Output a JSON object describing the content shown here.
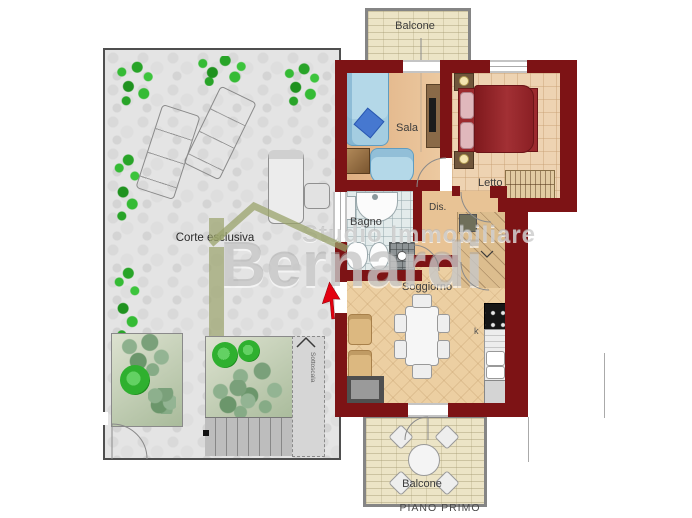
{
  "caption": {
    "floor": "PIANO PRIMO"
  },
  "rooms": {
    "balcone_top": {
      "label": "Balcone"
    },
    "sala": {
      "label": "Sala"
    },
    "letto": {
      "label": "Letto"
    },
    "bagno": {
      "label": "Bagno"
    },
    "dis": {
      "label": "Dis."
    },
    "soggiorno": {
      "label": "Soggiorno"
    },
    "kitchen": {
      "label": "k"
    },
    "corte": {
      "label": "Corte esclusiva"
    },
    "balcone_bottom": {
      "label": "Balcone"
    },
    "sottoscala": {
      "label": "Sottoscala"
    }
  },
  "watermark": {
    "line1": "Studio Immobiliare",
    "line2": "Bernardi"
  },
  "colors": {
    "wall": "#7d1315",
    "sala_floor": "#e6bd90",
    "letto_floor": "#eed3b2",
    "soggiorno_floor": "#eccfa2",
    "bagno_floor": "#e3ebeb",
    "balcony_floor": "#ece4c6",
    "courtyard": "#e4e4e4",
    "plant_green": "#2db32d",
    "bed_red": "#8e2026",
    "sofa_blue": "#b4d8e8",
    "logo_olive": "#9aa36b",
    "entrance_arrow": "#e30010"
  }
}
